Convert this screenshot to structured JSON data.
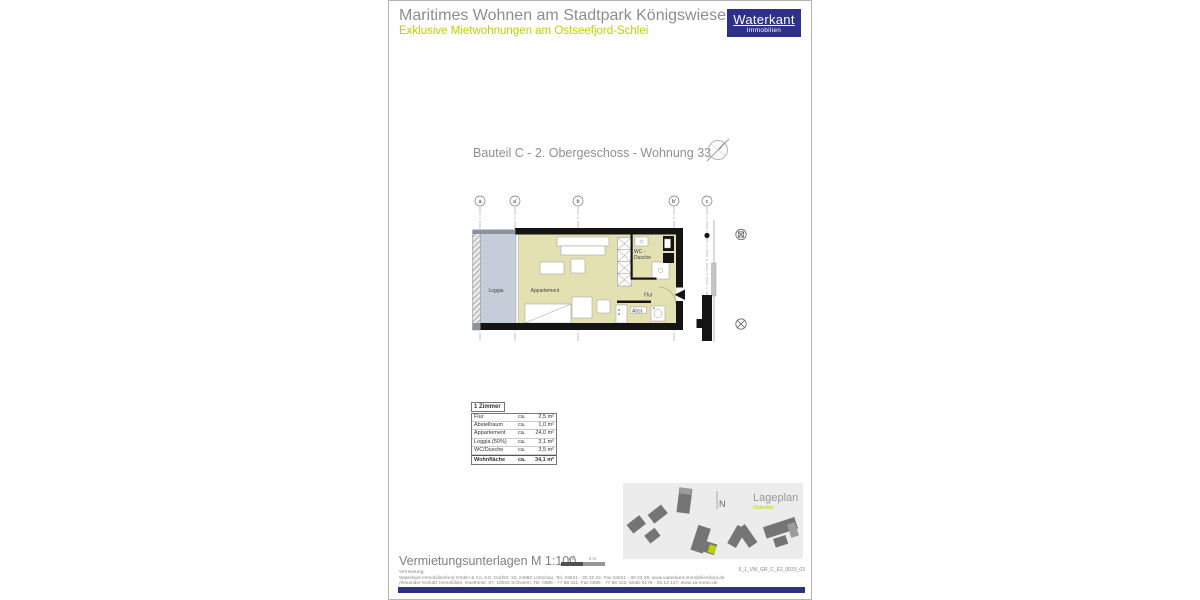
{
  "header": {
    "title": "Maritimes Wohnen am Stadtpark Königswiesen",
    "subtitle": "Exklusive Mietwohnungen am Ostseefjord-Schlei",
    "logo_name": "Waterkant",
    "logo_sub": "Immobilien"
  },
  "plan": {
    "title": "Bauteil C - 2. Obergeschoss - Wohnung 33",
    "grid_labels": [
      "a",
      "a'",
      "b",
      "b'",
      "c"
    ],
    "room_labels": {
      "loggia": "Loggia",
      "apartment": "Appartement",
      "wc_line1": "WC -",
      "wc_line2": "Dusche",
      "flur": "Flur",
      "abstell": "Abst."
    }
  },
  "area_table": {
    "header": "1 Zimmer",
    "rows": [
      {
        "label": "Flur",
        "approx": "ca.",
        "value": "2,5 m²"
      },
      {
        "label": "Abstellraum",
        "approx": "ca.",
        "value": "1,0 m²"
      },
      {
        "label": "Appartement",
        "approx": "ca.",
        "value": "24,0 m²"
      },
      {
        "label": "Loggia (50%)",
        "approx": "ca.",
        "value": "3,1 m²"
      },
      {
        "label": "WC/Dusche",
        "approx": "ca.",
        "value": "3,5 m²"
      }
    ],
    "total": {
      "label": "Wohnfläche",
      "approx": "ca.",
      "value": "34,1 m²"
    }
  },
  "siteplan": {
    "title": "Lageplan",
    "subtitle": "Standort",
    "north_label": "N"
  },
  "footer": {
    "doc_type": "Vermietungsunterlagen M 1:100",
    "scale_label_1": "1 m",
    "scale_label_2": "2 m",
    "doc_number": "5_1_VM_GR_C_E2_0033_03",
    "contact_heading": "Vermietung:",
    "contact_line_1": "Waterkant Immobilienfond GmbH & Co. KG, Dorfstr. 10, 24850 Lürschau, Tel. 04621 - 30 22 22, Fax 04621 - 30 22 29, www.waterkant-immobilienfond.de",
    "contact_line_2": "Alexander Schultz Immobilien, Goethestr. 97, 19053 Schwerin, Tel. 0385 - 77 88 411, Fax 0385 - 77 88 422, Mobil 0178 - 35 13 147, www.1a-immo.de"
  },
  "colors": {
    "brand_navy": "#2d3188",
    "accent_green": "#bdd000",
    "title_gray": "#8e8e8e",
    "plan_floor": "#e3e0b2",
    "plan_loggia": "#c5ced8",
    "siteplan_bg": "#ececec",
    "siteplan_building": "#757575"
  }
}
